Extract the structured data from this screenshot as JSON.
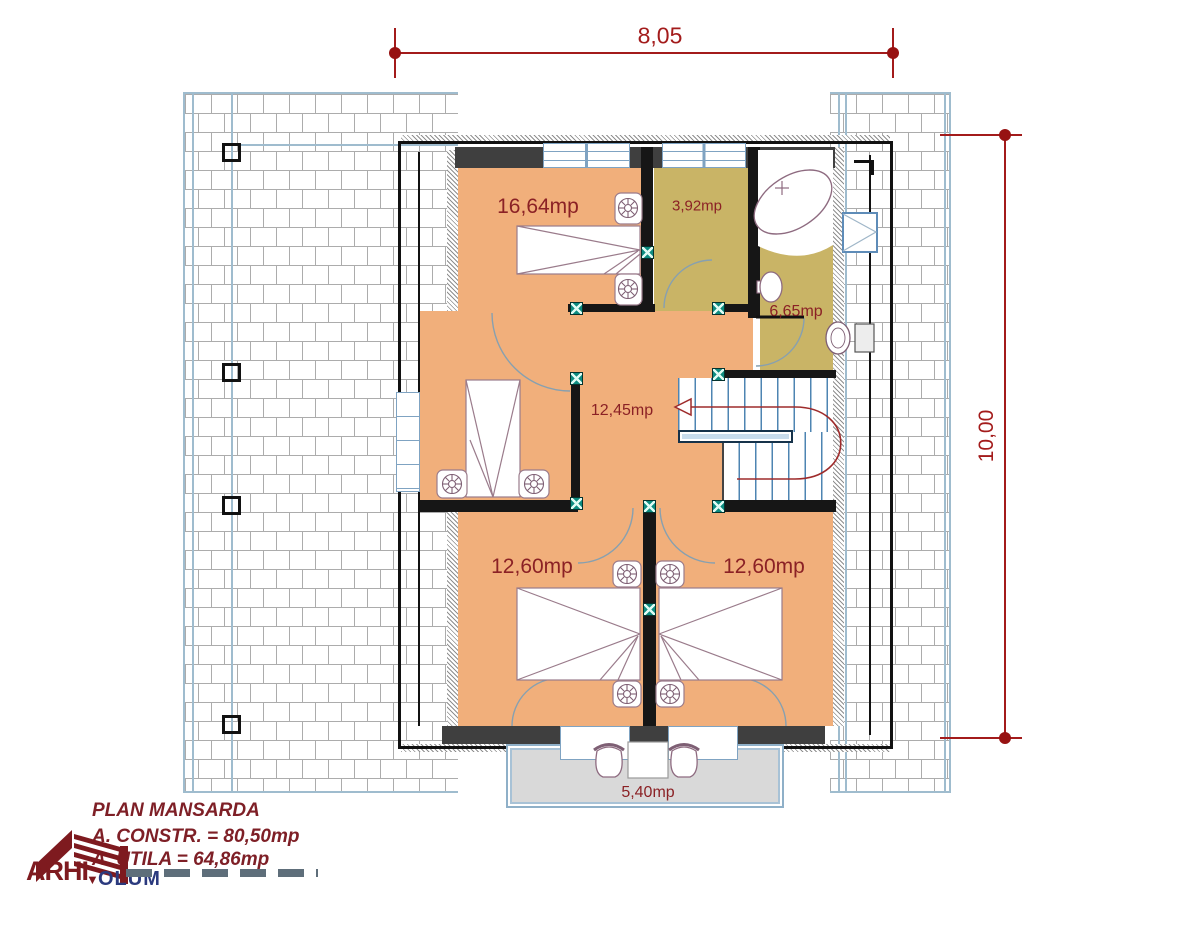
{
  "drawing": {
    "title_block": {
      "title": "PLAN MANSARDA",
      "built_area": "A. CONSTR. = 80,50mp",
      "usable_area": "A. UTILA = 64,86mp"
    },
    "logo": {
      "part1": "ARHI",
      "mark": "▼",
      "part2": "OLUM"
    },
    "dimensions": {
      "width": "8,05",
      "height": "10,00"
    },
    "rooms": [
      {
        "name": "bedroom-master",
        "area": "16,64mp"
      },
      {
        "name": "dressing",
        "area": "3,92mp"
      },
      {
        "name": "bathroom",
        "area": "6,65mp"
      },
      {
        "name": "hall",
        "area": "12,45mp"
      },
      {
        "name": "bedroom-left",
        "area": "12,60mp"
      },
      {
        "name": "bedroom-right",
        "area": "12,60mp"
      },
      {
        "name": "balcony",
        "area": "5,40mp"
      }
    ],
    "colors": {
      "room_fill": "#F1AF7B",
      "wet_room_fill": "#C9B466",
      "balcony_fill": "#D9D9D9",
      "wall": "#161616",
      "wall_gray": "#3F3F3F",
      "dimension_red": "#A31B1B",
      "label_red": "#8B2125",
      "roof_line": "#ACACAC",
      "roof_edge_blue": "#9FBCCE",
      "marker_teal": "#0D8C80",
      "stair_tread_blue": "#4E84B2"
    }
  }
}
